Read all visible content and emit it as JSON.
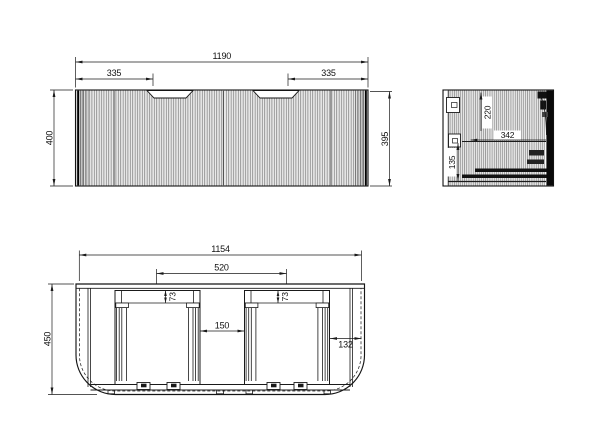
{
  "drawing": {
    "front_view": {
      "overall_width": "1190",
      "handle_offset_left": "335",
      "handle_offset_right": "335",
      "height_left": "400",
      "height_right": "395"
    },
    "side_view": {
      "upper_depth": "220",
      "internal_depth": "342",
      "runner_height": "135"
    },
    "plan_view": {
      "body_width": "1154",
      "inner_span": "520",
      "drawer_clearance_left": "73",
      "drawer_clearance_right": "73",
      "centre_gap": "150",
      "side_clearance": "132",
      "overall_depth": "450"
    },
    "colors": {
      "line": "#1a1a1a",
      "background": "#ffffff"
    }
  }
}
